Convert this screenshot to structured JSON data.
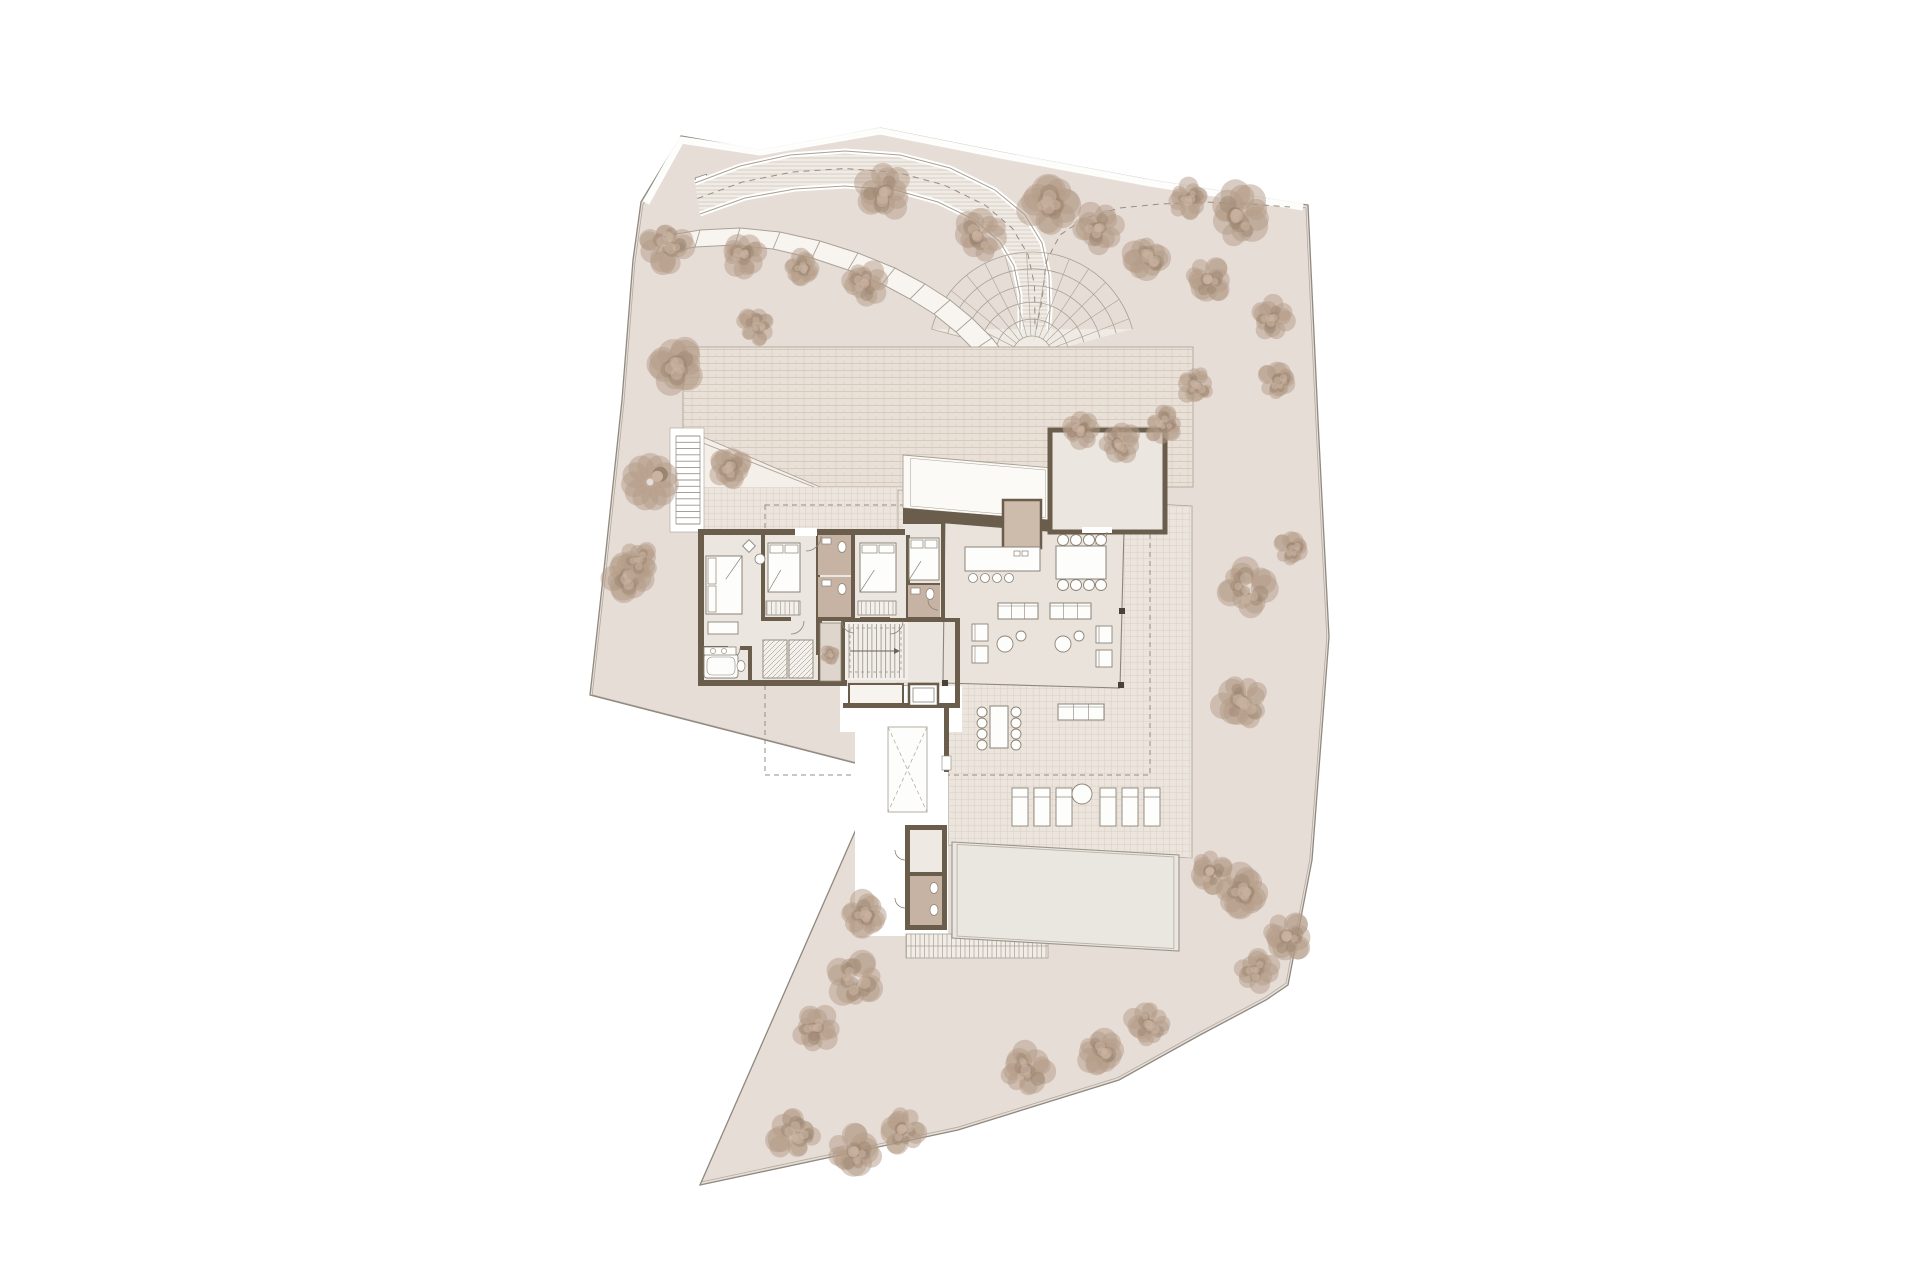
{
  "canvas": {
    "w": 1920,
    "h": 1280,
    "bg": "#ffffff"
  },
  "palette": {
    "site": "#e6ddd6",
    "siteLine": "#8f897f",
    "siteInner": "#b3aba1",
    "wall": "#6a5d4c",
    "wallDark": "#4a4138",
    "room": "#ebe6e0",
    "pavilion": "#e9e3dc",
    "bath": "#c6b3a3",
    "patio": "#ded5cc",
    "brickFill": "#e9e0d8",
    "brickLine": "#d2c5b9",
    "gridFill": "#ece5dd",
    "gridLine": "#d9cfc5",
    "rampFill": "#f0ebe5",
    "rampHatch": "#cdc3b8",
    "edge": "#a9a195",
    "stepFill": "#f8f5f1",
    "white": "#ffffff",
    "offwhite": "#fbfaf7",
    "furn": "#8c8376",
    "furnFill": "#fdfdfc",
    "pool": "#eae7e0",
    "poolRim": "#b9b3a9",
    "poolLine": "#9a948a",
    "dash": "#968d81",
    "treeBase": "#b49b87",
    "treeDark": "#9b8470",
    "treeLight": "#c9b4a1"
  },
  "site": {
    "boundary": [
      [
        641,
        202
      ],
      [
        681,
        136
      ],
      [
        760,
        150
      ],
      [
        880,
        128
      ],
      [
        1000,
        152
      ],
      [
        1150,
        180
      ],
      [
        1308,
        205
      ],
      [
        1318,
        420
      ],
      [
        1329,
        637
      ],
      [
        1312,
        860
      ],
      [
        1288,
        985
      ],
      [
        1266,
        1000
      ],
      [
        1200,
        1035
      ],
      [
        1119,
        1080
      ],
      [
        958,
        1130
      ],
      [
        700,
        1185
      ],
      [
        882,
        770
      ],
      [
        590,
        695
      ],
      [
        605,
        560
      ],
      [
        622,
        400
      ],
      [
        633,
        260
      ]
    ],
    "innerScale": 0.994,
    "innerCenter": [
      960,
      660
    ],
    "topVerge": [
      [
        646,
        203
      ],
      [
        681,
        140
      ],
      [
        760,
        152
      ],
      [
        880,
        131
      ],
      [
        1000,
        155
      ],
      [
        1150,
        183
      ],
      [
        1303,
        207
      ]
    ],
    "gate": {
      "x": 695,
      "y": 178,
      "w": 12,
      "h": 9
    }
  },
  "roads": {
    "rampOuter": [
      [
        695,
        183
      ],
      [
        740,
        166
      ],
      [
        790,
        155
      ],
      [
        845,
        151
      ],
      [
        900,
        155
      ],
      [
        950,
        168
      ],
      [
        995,
        190
      ],
      [
        1025,
        215
      ],
      [
        1042,
        243
      ],
      [
        1049,
        275
      ],
      [
        1050,
        310
      ],
      [
        1048,
        340
      ]
    ],
    "rampInner": [
      [
        700,
        214
      ],
      [
        745,
        198
      ],
      [
        795,
        189
      ],
      [
        845,
        186
      ],
      [
        895,
        190
      ],
      [
        938,
        202
      ],
      [
        975,
        220
      ],
      [
        1000,
        242
      ],
      [
        1014,
        266
      ],
      [
        1020,
        295
      ],
      [
        1020,
        340
      ]
    ],
    "stepsOuter": [
      [
        665,
        236
      ],
      [
        700,
        230
      ],
      [
        740,
        228
      ],
      [
        780,
        232
      ],
      [
        820,
        241
      ],
      [
        858,
        253
      ],
      [
        895,
        268
      ],
      [
        925,
        284
      ],
      [
        950,
        300
      ],
      [
        972,
        318
      ],
      [
        992,
        338
      ],
      [
        1006,
        356
      ],
      [
        1012,
        368
      ]
    ],
    "stepsInner": [
      [
        656,
        254
      ],
      [
        695,
        247
      ],
      [
        735,
        245
      ],
      [
        773,
        249
      ],
      [
        812,
        258
      ],
      [
        848,
        270
      ],
      [
        882,
        284
      ],
      [
        910,
        299
      ],
      [
        934,
        314
      ],
      [
        956,
        332
      ],
      [
        974,
        350
      ],
      [
        988,
        366
      ],
      [
        996,
        376
      ]
    ],
    "centerline2": [
      [
        1034,
        340
      ],
      [
        1042,
        300
      ],
      [
        1046,
        262
      ],
      [
        1060,
        235
      ],
      [
        1085,
        218
      ],
      [
        1120,
        208
      ],
      [
        1160,
        204
      ],
      [
        1205,
        202
      ],
      [
        1250,
        204
      ],
      [
        1290,
        207
      ]
    ],
    "fan": {
      "cx": 1032,
      "cy": 356,
      "r0": 20,
      "r1": 104,
      "rings": 6,
      "a0": 195,
      "a1": 345,
      "radialStep": 12
    }
  },
  "paving": {
    "courtyard": {
      "x": 683,
      "y": 347,
      "w": 510,
      "h": 140
    },
    "gridStrip": {
      "x": 700,
      "y": 487,
      "w": 203,
      "h": 45
    },
    "terrace": [
      [
        898,
        490
      ],
      [
        1192,
        506
      ],
      [
        1192,
        858
      ],
      [
        948,
        845
      ],
      [
        948,
        688
      ],
      [
        898,
        685
      ]
    ],
    "dashedRect": {
      "x": 765,
      "y": 505,
      "w": 385,
      "h": 270
    },
    "roofBand": [
      [
        903,
        455
      ],
      [
        1053,
        468
      ],
      [
        1053,
        521
      ],
      [
        903,
        508
      ]
    ],
    "diagRoof": {
      "tri": [
        [
          703,
          437
        ],
        [
          820,
          487
        ],
        [
          703,
          487
        ]
      ],
      "l1": [
        [
          703,
          437
        ],
        [
          820,
          487
        ]
      ],
      "l2": [
        [
          703,
          443
        ],
        [
          814,
          487
        ]
      ]
    },
    "walkways": [
      {
        "x": 840,
        "y": 686,
        "w": 122,
        "h": 46
      },
      {
        "x": 855,
        "y": 708,
        "w": 93,
        "h": 228
      }
    ],
    "stepsSouth": {
      "x": 906,
      "y": 934,
      "w": 142,
      "h": 24
    },
    "stairWest": {
      "bg": {
        "x": 670,
        "y": 428,
        "w": 34,
        "h": 104
      },
      "x": 676,
      "y": 436,
      "w": 24,
      "h": 88,
      "n": 14
    },
    "xlight": {
      "x": 888,
      "y": 727,
      "w": 39,
      "h": 85
    }
  },
  "house": {
    "wingFloor": [
      {
        "x": 700,
        "y": 531,
        "w": 240,
        "h": 151
      },
      {
        "x": 903,
        "y": 521,
        "w": 42,
        "h": 161
      }
    ],
    "pavilionFloor": [
      [
        945,
        520
      ],
      [
        1124,
        529
      ],
      [
        1120,
        688
      ],
      [
        943,
        683
      ]
    ],
    "pavilionWall": [
      [
        903,
        508
      ],
      [
        1053,
        520
      ],
      [
        1053,
        532
      ],
      [
        903,
        520
      ]
    ],
    "glassEdges": [
      [
        [
          1053,
          526
        ],
        [
          1124,
          529
        ]
      ],
      [
        [
          1124,
          529
        ],
        [
          1120,
          688
        ]
      ],
      [
        [
          1120,
          688
        ],
        [
          943,
          683
        ]
      ],
      [
        [
          945,
          520
        ],
        [
          943,
          683
        ]
      ]
    ],
    "columns": [
      [
        1121,
        531
      ],
      [
        1122,
        611
      ],
      [
        1121,
        685
      ],
      [
        945,
        683
      ]
    ],
    "walls": [
      [
        698,
        529,
        207,
        6
      ],
      [
        698,
        529,
        6,
        157
      ],
      [
        698,
        680,
        149,
        6
      ],
      [
        845,
        618,
        115,
        4
      ],
      [
        843,
        703,
        117,
        5
      ],
      [
        955,
        618,
        5,
        90
      ],
      [
        761,
        535,
        4,
        84
      ],
      [
        816,
        535,
        4,
        120
      ],
      [
        851,
        535,
        4,
        84
      ],
      [
        906,
        535,
        4,
        84
      ],
      [
        941,
        521,
        4,
        99
      ],
      [
        903,
        520,
        42,
        4
      ],
      [
        761,
        617,
        30,
        4
      ],
      [
        816,
        617,
        38,
        4
      ],
      [
        860,
        617,
        30,
        4
      ],
      [
        906,
        617,
        35,
        4
      ],
      [
        700,
        646,
        28,
        4
      ],
      [
        740,
        646,
        12,
        4
      ],
      [
        748,
        646,
        4,
        38
      ],
      [
        818,
        621,
        4,
        62
      ],
      [
        841,
        621,
        4,
        62
      ],
      [
        906,
        583,
        34,
        4
      ],
      [
        906,
        583,
        4,
        34
      ]
    ],
    "entryGap": {
      "x": 795,
      "y": 528,
      "w": 22,
      "h": 8
    },
    "garage": {
      "x": 1050,
      "y": 430,
      "w": 115,
      "h": 102,
      "door": {
        "x": 1082,
        "y": 527,
        "w": 30,
        "h": 6
      }
    },
    "pantry": {
      "x": 1003,
      "y": 500,
      "w": 38,
      "h": 48
    },
    "bathA1": {
      "x": 818,
      "y": 535,
      "w": 33,
      "h": 40
    },
    "bathA2": {
      "x": 818,
      "y": 577,
      "w": 33,
      "h": 40
    },
    "bathB": {
      "x": 908,
      "y": 585,
      "w": 32,
      "h": 32
    },
    "patio": {
      "x": 820,
      "y": 623,
      "w": 21,
      "h": 58
    },
    "closets": [
      {
        "x": 763,
        "y": 640,
        "w": 24,
        "h": 38
      },
      {
        "x": 789,
        "y": 640,
        "w": 24,
        "h": 38
      }
    ],
    "stairHall": {
      "x": 845,
      "y": 622,
      "w": 63,
      "h": 58,
      "n": 12
    },
    "storage": {
      "x": 849,
      "y": 684,
      "w": 54,
      "h": 20
    },
    "elevator": {
      "x": 909,
      "y": 684,
      "w": 29,
      "h": 22
    },
    "doors": [
      [
        791,
        621,
        13,
        0,
        90
      ],
      [
        854,
        621,
        12,
        90,
        180
      ],
      [
        890,
        621,
        13,
        0,
        90
      ],
      [
        806,
        536,
        15,
        0,
        90
      ],
      [
        728,
        648,
        12,
        0,
        90
      ],
      [
        905,
        850,
        10,
        90,
        180
      ],
      [
        905,
        898,
        10,
        90,
        180
      ],
      [
        1095,
        532,
        12,
        0,
        90
      ],
      [
        938,
        600,
        10,
        90,
        180
      ]
    ],
    "wardrobes": [
      {
        "x": 766,
        "y": 601,
        "w": 34,
        "h": 14
      },
      {
        "x": 858,
        "y": 601,
        "w": 38,
        "h": 14
      },
      {
        "x": 909,
        "y": 566,
        "w": 30,
        "h": 12
      }
    ]
  },
  "poolArea": {
    "pool": [
      [
        952,
        842
      ],
      [
        1179,
        855
      ],
      [
        1179,
        951
      ],
      [
        952,
        938
      ]
    ],
    "bathBlock": {
      "x": 905,
      "y": 825,
      "w": 42,
      "h": 105,
      "roomTop": {
        "x": 910,
        "y": 830,
        "w": 32,
        "h": 42
      },
      "roomBot": {
        "x": 910,
        "y": 876,
        "w": 32,
        "h": 49
      },
      "ovals": [
        [
          934,
          888
        ],
        [
          934,
          910
        ]
      ]
    },
    "walkWall": {
      "x": 944,
      "y": 708,
      "w": 5,
      "h": 64
    },
    "doorTicks": {
      "x": 942,
      "y": 756,
      "w": 9,
      "h": 14
    }
  },
  "furniture": {
    "beds": [
      {
        "x": 706,
        "y": 556,
        "w": 36,
        "h": 58,
        "dir": "v"
      },
      {
        "x": 768,
        "y": 543,
        "w": 32,
        "h": 49,
        "dir": "h"
      },
      {
        "x": 860,
        "y": 543,
        "w": 36,
        "h": 49,
        "dir": "h"
      },
      {
        "x": 909,
        "y": 538,
        "w": 30,
        "h": 42,
        "dir": "h"
      }
    ],
    "decor": {
      "diamond": [
        749,
        546,
        9
      ],
      "circle": [
        760,
        559,
        5
      ],
      "desk": {
        "x": 708,
        "y": 622,
        "w": 30,
        "h": 12
      }
    },
    "kitchen": {
      "island": {
        "x": 965,
        "y": 547,
        "w": 75,
        "h": 24
      },
      "stools": [
        [
          973,
          578
        ],
        [
          985,
          578
        ],
        [
          997,
          578
        ],
        [
          1009,
          578
        ]
      ],
      "cook": [
        [
          1014,
          551
        ],
        [
          1022,
          551
        ]
      ]
    },
    "dining": {
      "table": {
        "x": 1056,
        "y": 546,
        "w": 50,
        "h": 33
      },
      "chairs": [
        [
          1063,
          540
        ],
        [
          1076,
          540
        ],
        [
          1089,
          540
        ],
        [
          1101,
          540
        ],
        [
          1063,
          585
        ],
        [
          1076,
          585
        ],
        [
          1089,
          585
        ],
        [
          1101,
          585
        ]
      ]
    },
    "sofas": [
      {
        "x": 998,
        "y": 603,
        "w": 40,
        "h": 16,
        "n": 3
      },
      {
        "x": 1050,
        "y": 603,
        "w": 41,
        "h": 16,
        "n": 3
      },
      {
        "x": 1058,
        "y": 704,
        "w": 46,
        "h": 16,
        "n": 3
      },
      {
        "x": 1092,
        "y": 996,
        "w": 0,
        "h": 0,
        "n": 0
      }
    ],
    "armchairs": [
      [
        972,
        624
      ],
      [
        972,
        646
      ],
      [
        1096,
        626
      ],
      [
        1096,
        650
      ]
    ],
    "roundTables": [
      [
        1005,
        644,
        8
      ],
      [
        1021,
        636,
        5
      ],
      [
        1063,
        644,
        8
      ],
      [
        1079,
        636,
        5
      ]
    ],
    "outDining": {
      "table": {
        "x": 990,
        "y": 706,
        "w": 18,
        "h": 42
      },
      "chairs": [
        [
          982,
          712
        ],
        [
          982,
          723
        ],
        [
          982,
          734
        ],
        [
          982,
          745
        ],
        [
          1016,
          712
        ],
        [
          1016,
          723
        ],
        [
          1016,
          734
        ],
        [
          1016,
          745
        ]
      ]
    },
    "loungers": {
      "y": 788,
      "h": 38,
      "w": 16,
      "xs": [
        1012,
        1034,
        1056,
        1100,
        1122,
        1144
      ],
      "circle": [
        1082,
        794,
        10
      ]
    },
    "tub": {
      "x": 704,
      "y": 654,
      "w": 34,
      "h": 24
    },
    "sinkCounter": {
      "x": 704,
      "y": 647,
      "w": 32,
      "h": 8
    },
    "toiletSW": [
      741,
      666
    ],
    "bathFix": [
      [
        842,
        547
      ],
      [
        842,
        589
      ],
      [
        930,
        594
      ]
    ],
    "sinks": [
      [
        822,
        538
      ],
      [
        822,
        580
      ],
      [
        911,
        588
      ]
    ]
  },
  "trees": [
    [
      666,
      246,
      28
    ],
    [
      743,
      255,
      24
    ],
    [
      802,
      268,
      20
    ],
    [
      755,
      327,
      20
    ],
    [
      865,
      283,
      22
    ],
    [
      884,
      192,
      32
    ],
    [
      980,
      235,
      28
    ],
    [
      1050,
      205,
      34
    ],
    [
      1098,
      228,
      28
    ],
    [
      1148,
      258,
      26
    ],
    [
      1188,
      200,
      22
    ],
    [
      1240,
      214,
      34
    ],
    [
      1208,
      280,
      26
    ],
    [
      1272,
      318,
      24
    ],
    [
      1278,
      380,
      22
    ],
    [
      1196,
      385,
      20
    ],
    [
      1292,
      548,
      20
    ],
    [
      1247,
      588,
      28
    ],
    [
      1242,
      702,
      30
    ],
    [
      1210,
      872,
      24
    ],
    [
      1242,
      892,
      30
    ],
    [
      1287,
      937,
      28
    ],
    [
      1257,
      970,
      24
    ],
    [
      1148,
      1024,
      24
    ],
    [
      1100,
      1050,
      26
    ],
    [
      1026,
      1070,
      28
    ],
    [
      902,
      1130,
      26
    ],
    [
      854,
      1152,
      30
    ],
    [
      794,
      1136,
      28
    ],
    [
      816,
      1028,
      26
    ],
    [
      855,
      979,
      28
    ],
    [
      864,
      915,
      26
    ],
    [
      628,
      577,
      26
    ],
    [
      650,
      482,
      26
    ],
    [
      676,
      365,
      30
    ],
    [
      640,
      560,
      22
    ],
    [
      730,
      467,
      22
    ],
    [
      1080,
      430,
      20
    ],
    [
      1120,
      442,
      22
    ],
    [
      1162,
      425,
      20
    ]
  ],
  "plant": [
    830,
    655,
    11
  ]
}
